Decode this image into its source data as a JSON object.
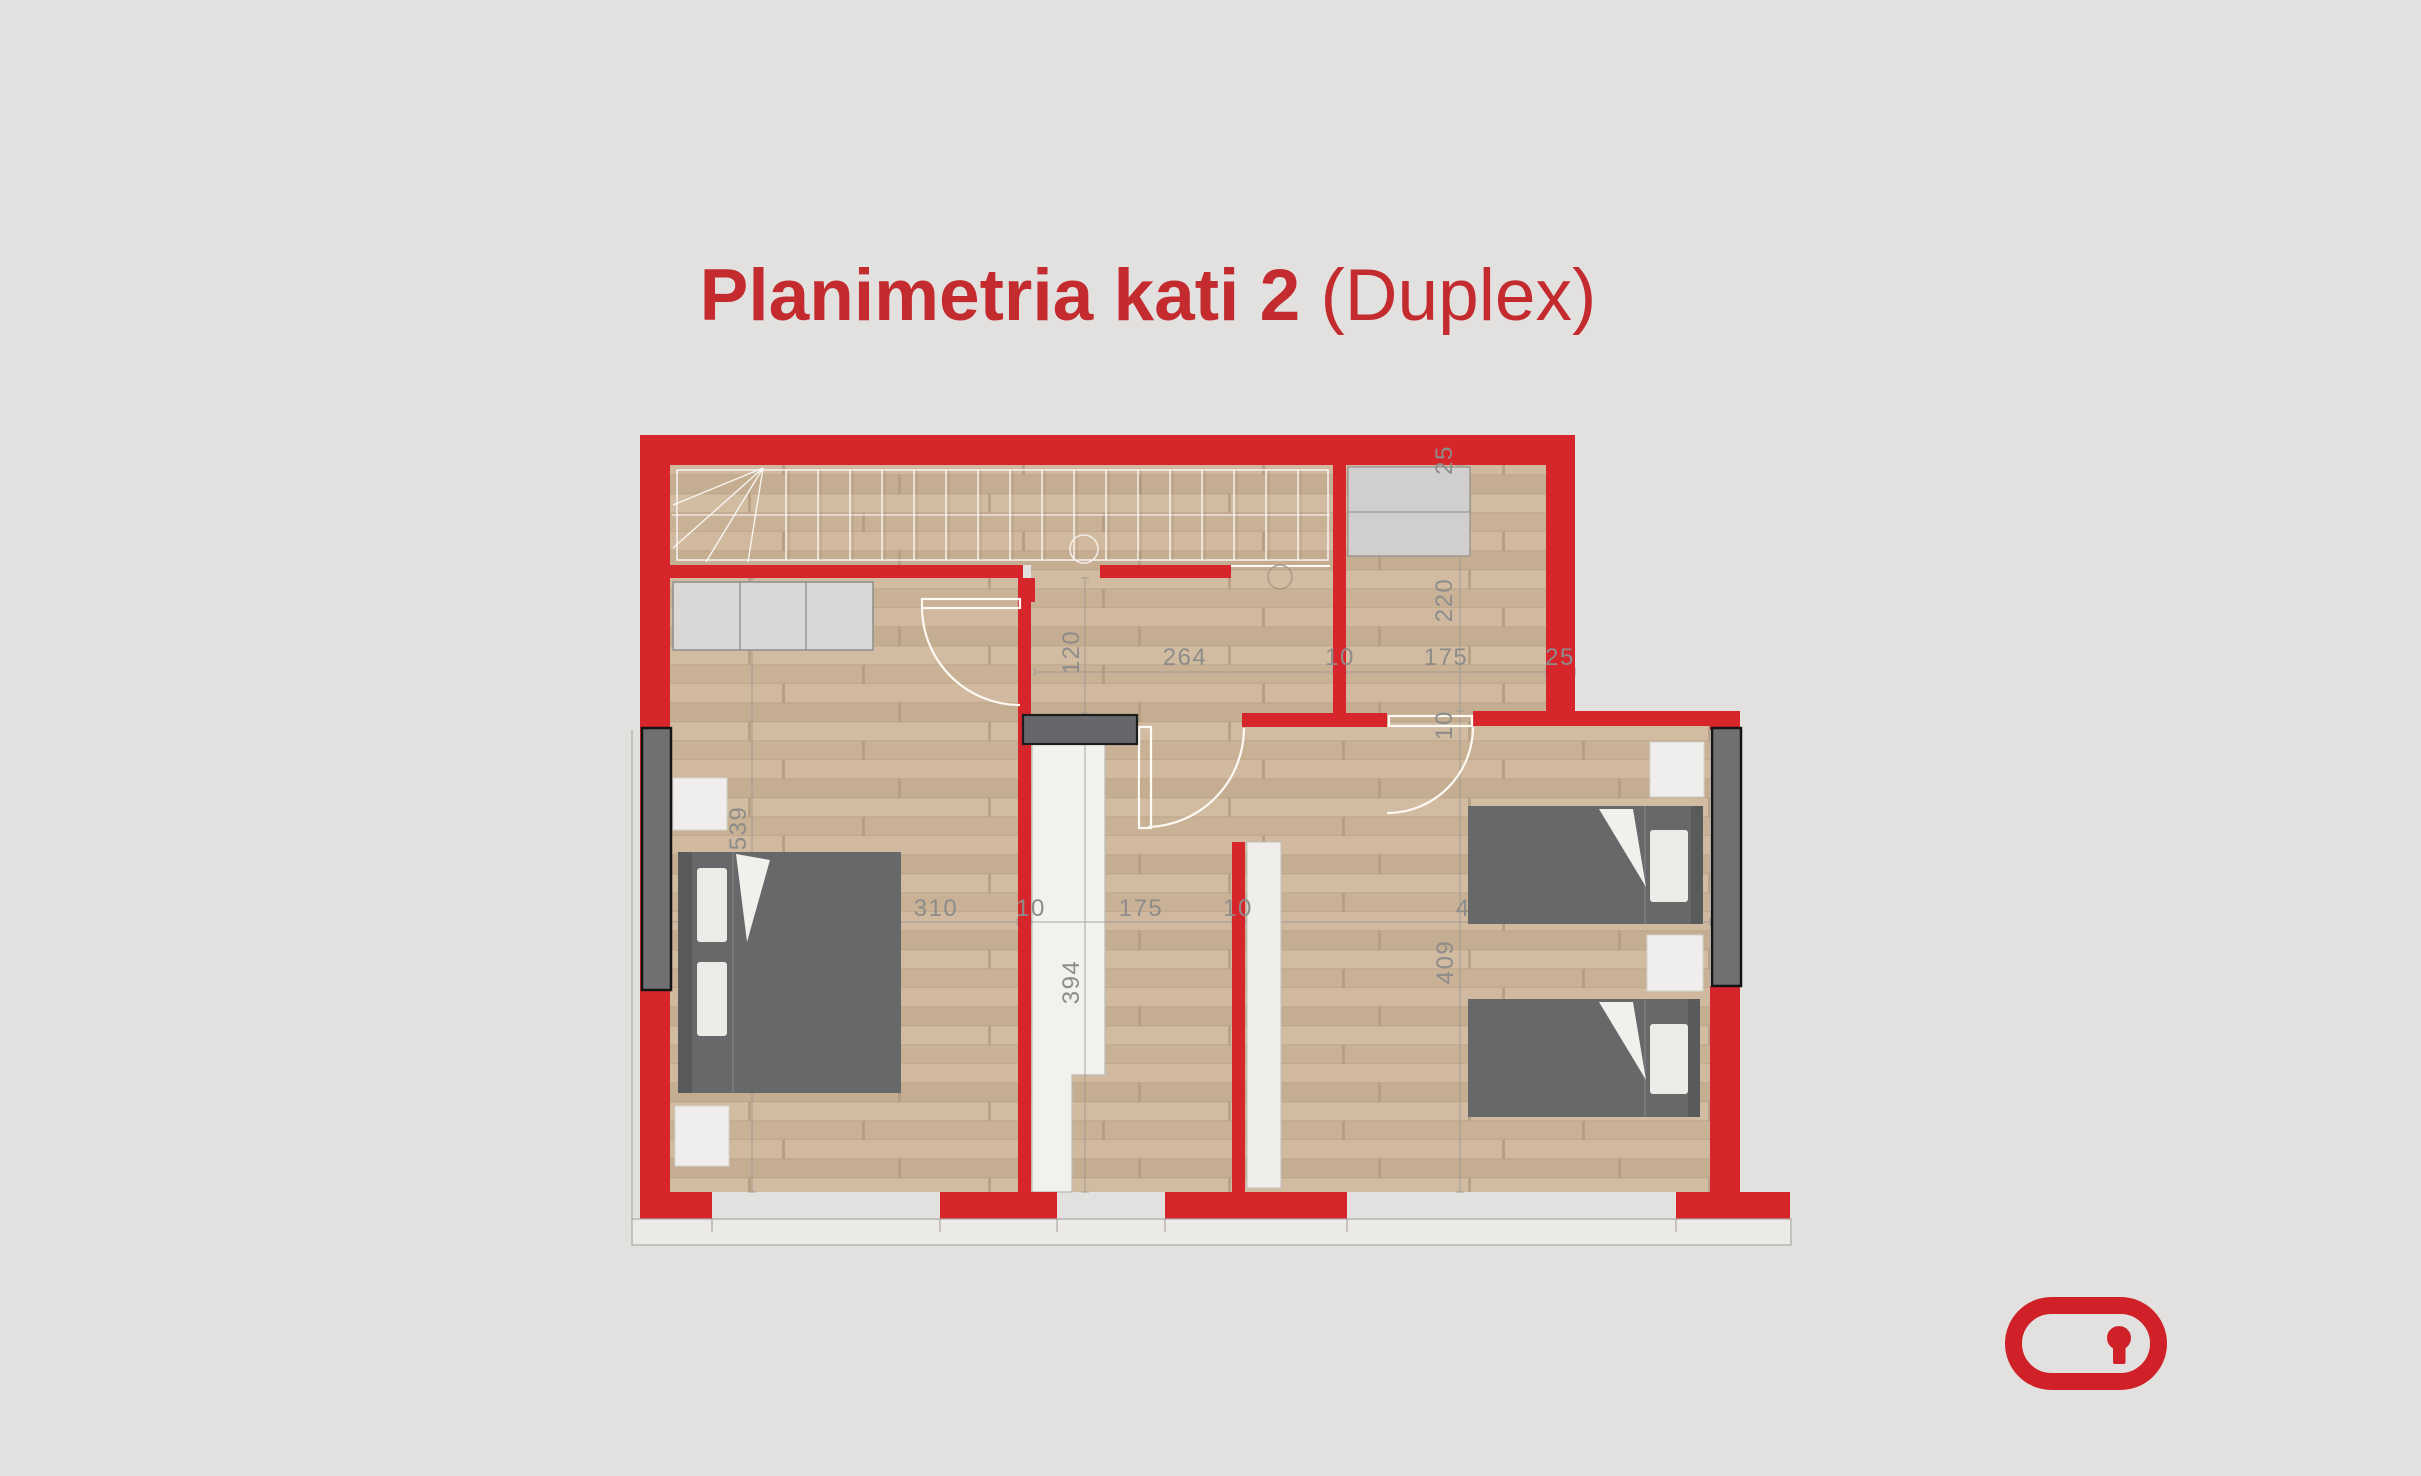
{
  "title": {
    "main": "Planimetria kati 2 ",
    "suffix": "(Duplex)"
  },
  "colors": {
    "background": "#e2e1df",
    "wall_red": "#d6262c",
    "title_red": "#c42b2f",
    "logo_red": "#cf2127",
    "floor_wood": "#cbb499",
    "furniture_dark": "#67686a",
    "furniture_light": "#f0eeeb",
    "dimension_text": "#8d8c8a"
  },
  "floor_plan": {
    "dims": [
      {
        "id": "top-wall-thickness",
        "value": "25"
      },
      {
        "id": "top-right-room-height",
        "value": "220"
      },
      {
        "id": "top-right-room-bottom-wall",
        "value": "10"
      },
      {
        "id": "hall-width",
        "value": "264"
      },
      {
        "id": "top-right-room-left-wall",
        "value": "10"
      },
      {
        "id": "top-right-room-width",
        "value": "175"
      },
      {
        "id": "top-right-room-right-wall",
        "value": "25"
      },
      {
        "id": "upper-passage-height",
        "value": "120"
      },
      {
        "id": "left-bedroom-height",
        "value": "539"
      },
      {
        "id": "left-bedroom-width",
        "value": "310"
      },
      {
        "id": "left-bedroom-right-wall",
        "value": "10"
      },
      {
        "id": "corridor-width",
        "value": "175"
      },
      {
        "id": "corridor-right-wall",
        "value": "10"
      },
      {
        "id": "right-bedroom-width",
        "value": "410"
      },
      {
        "id": "stair-void-length",
        "value": "394"
      },
      {
        "id": "right-bedroom-height",
        "value": "409"
      }
    ]
  }
}
